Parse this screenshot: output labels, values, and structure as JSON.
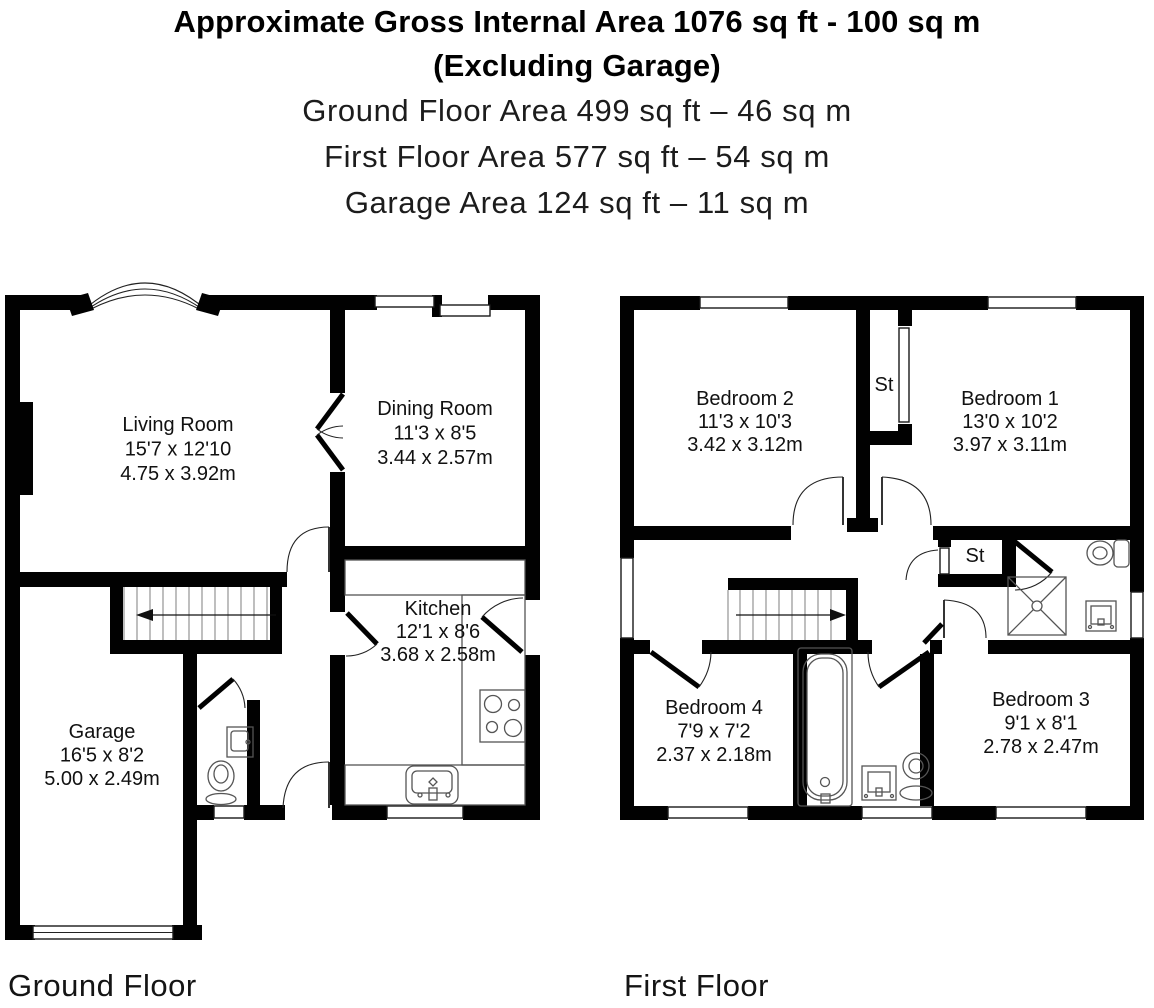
{
  "header": {
    "title_line1": "Approximate Gross Internal Area 1076 sq ft - 100 sq m",
    "title_line2": "(Excluding Garage)",
    "subtitle_lines": [
      "Ground Floor Area 499 sq ft – 46 sq m",
      "First Floor Area 577 sq ft – 54 sq m",
      "Garage Area 124 sq ft – 11 sq m"
    ]
  },
  "ground_floor": {
    "label": "Ground Floor",
    "rooms": [
      {
        "name": "Living Room",
        "imperial": "15'7 x 12'10",
        "metric": "4.75 x 3.92m"
      },
      {
        "name": "Dining Room",
        "imperial": "11'3 x 8'5",
        "metric": "3.44 x 2.57m"
      },
      {
        "name": "Kitchen",
        "imperial": "12'1 x 8'6",
        "metric": "3.68 x 2.58m"
      },
      {
        "name": "Garage",
        "imperial": "16'5 x 8'2",
        "metric": "5.00 x 2.49m"
      }
    ]
  },
  "first_floor": {
    "label": "First Floor",
    "rooms": [
      {
        "name": "Bedroom 2",
        "imperial": "11'3 x 10'3",
        "metric": "3.42 x 3.12m"
      },
      {
        "name": "Bedroom 1",
        "imperial": "13'0 x 10'2",
        "metric": "3.97 x 3.11m"
      },
      {
        "name": "Bedroom 4",
        "imperial": "7'9 x 7'2",
        "metric": "2.37 x 2.18m"
      },
      {
        "name": "Bedroom 3",
        "imperial": "9'1 x 8'1",
        "metric": "2.78 x 2.47m"
      }
    ],
    "storage_labels": [
      "St",
      "St"
    ]
  },
  "colors": {
    "wall": "#010101",
    "background": "#ffffff",
    "fixture_line": "#555555",
    "text": "#111111"
  }
}
